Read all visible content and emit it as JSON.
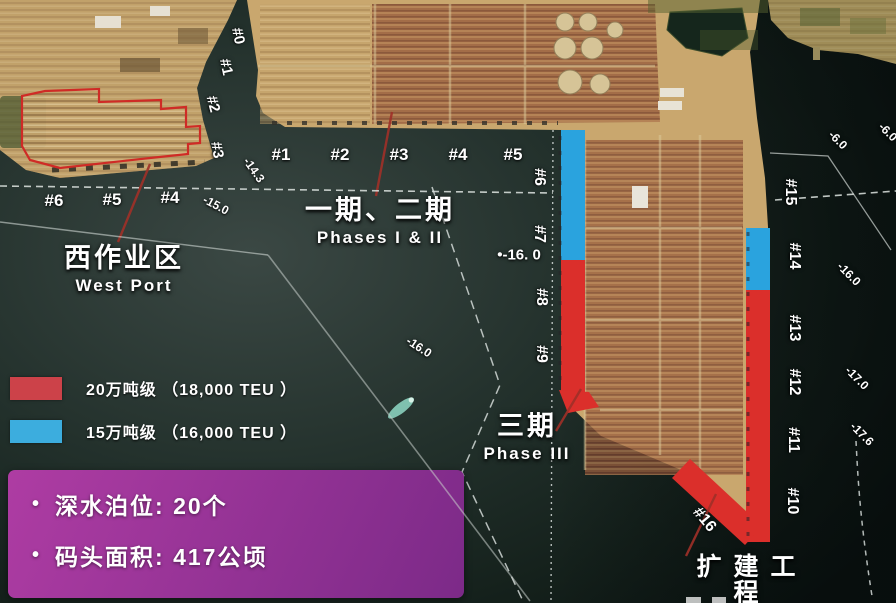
{
  "colors": {
    "berth_20w": "#db2f2b",
    "berth_15w": "#2aa3de",
    "legend_red": "#cc4249",
    "legend_blue": "#3cadde",
    "infobox_from": "#ae3ca3",
    "infobox_to": "#7c2a88",
    "outline_red": "#cf2b26",
    "leader_red": "#a03028"
  },
  "regions": {
    "west_port": {
      "zh": "西作业区",
      "en": "West Port"
    },
    "phase12": {
      "zh": "一期、二期",
      "en": "Phases I & II"
    },
    "phase3": {
      "zh": "三期",
      "en": "Phase III"
    },
    "expansion": {
      "zh": "扩建工程",
      "en": ""
    }
  },
  "legend": {
    "items": [
      {
        "color_key": "legend_red",
        "label": "20万吨级 （18,000 TEU ）"
      },
      {
        "color_key": "legend_blue",
        "label": "15万吨级 （16,000 TEU ）"
      }
    ]
  },
  "infobox": {
    "bullet": "•",
    "items": [
      "深水泊位: 20个",
      "码头面积: 417公顷"
    ]
  },
  "map": {
    "berth_labels": [
      {
        "t": "#0",
        "x": 238,
        "y": 36,
        "r": 78,
        "s": 15
      },
      {
        "t": "#1",
        "x": 226,
        "y": 67,
        "r": 78,
        "s": 15
      },
      {
        "t": "#2",
        "x": 213,
        "y": 104,
        "r": 75,
        "s": 15
      },
      {
        "t": "#3",
        "x": 217,
        "y": 150,
        "r": 80,
        "s": 15
      },
      {
        "t": "#1",
        "x": 281,
        "y": 155,
        "r": 0,
        "s": 17
      },
      {
        "t": "#2",
        "x": 340,
        "y": 155,
        "r": 0,
        "s": 17
      },
      {
        "t": "#3",
        "x": 399,
        "y": 155,
        "r": 0,
        "s": 17
      },
      {
        "t": "#4",
        "x": 458,
        "y": 155,
        "r": 0,
        "s": 17
      },
      {
        "t": "#5",
        "x": 513,
        "y": 155,
        "r": 0,
        "s": 17
      },
      {
        "t": "#6",
        "x": 54,
        "y": 201,
        "r": 0,
        "s": 17
      },
      {
        "t": "#5",
        "x": 112,
        "y": 200,
        "r": 0,
        "s": 17
      },
      {
        "t": "#4",
        "x": 170,
        "y": 198,
        "r": 0,
        "s": 17
      },
      {
        "t": "#6",
        "x": 539,
        "y": 177,
        "r": 90,
        "s": 16
      },
      {
        "t": "#7",
        "x": 539,
        "y": 234,
        "r": 90,
        "s": 16
      },
      {
        "t": "#8",
        "x": 541,
        "y": 297,
        "r": 90,
        "s": 16
      },
      {
        "t": "#9",
        "x": 541,
        "y": 354,
        "r": 90,
        "s": 16
      },
      {
        "t": "#15",
        "x": 790,
        "y": 192,
        "r": 90,
        "s": 16
      },
      {
        "t": "#14",
        "x": 794,
        "y": 256,
        "r": 90,
        "s": 16
      },
      {
        "t": "#13",
        "x": 794,
        "y": 328,
        "r": 90,
        "s": 16
      },
      {
        "t": "#12",
        "x": 794,
        "y": 382,
        "r": 90,
        "s": 16
      },
      {
        "t": "#11",
        "x": 793,
        "y": 440,
        "r": 90,
        "s": 16
      },
      {
        "t": "#10",
        "x": 792,
        "y": 501,
        "r": 90,
        "s": 16
      },
      {
        "t": "#16",
        "x": 704,
        "y": 520,
        "r": 50,
        "s": 16
      }
    ],
    "depth_labels": [
      {
        "t": "-14.3",
        "x": 254,
        "y": 170,
        "r": 55,
        "s": 12
      },
      {
        "t": "-15.0",
        "x": 216,
        "y": 205,
        "r": 28,
        "s": 12
      },
      {
        "t": "-16.0",
        "x": 419,
        "y": 347,
        "r": 33,
        "s": 12
      },
      {
        "t": "•-16. 0",
        "x": 519,
        "y": 255,
        "r": 0,
        "s": 15
      },
      {
        "t": "-6.0",
        "x": 838,
        "y": 140,
        "r": 45,
        "s": 12
      },
      {
        "t": "-6.0",
        "x": 888,
        "y": 132,
        "r": 45,
        "s": 12
      },
      {
        "t": "-16.0",
        "x": 849,
        "y": 274,
        "r": 45,
        "s": 12
      },
      {
        "t": "-17.0",
        "x": 857,
        "y": 378,
        "r": 45,
        "s": 12
      },
      {
        "t": "-17.6",
        "x": 862,
        "y": 434,
        "r": 45,
        "s": 12
      }
    ]
  }
}
